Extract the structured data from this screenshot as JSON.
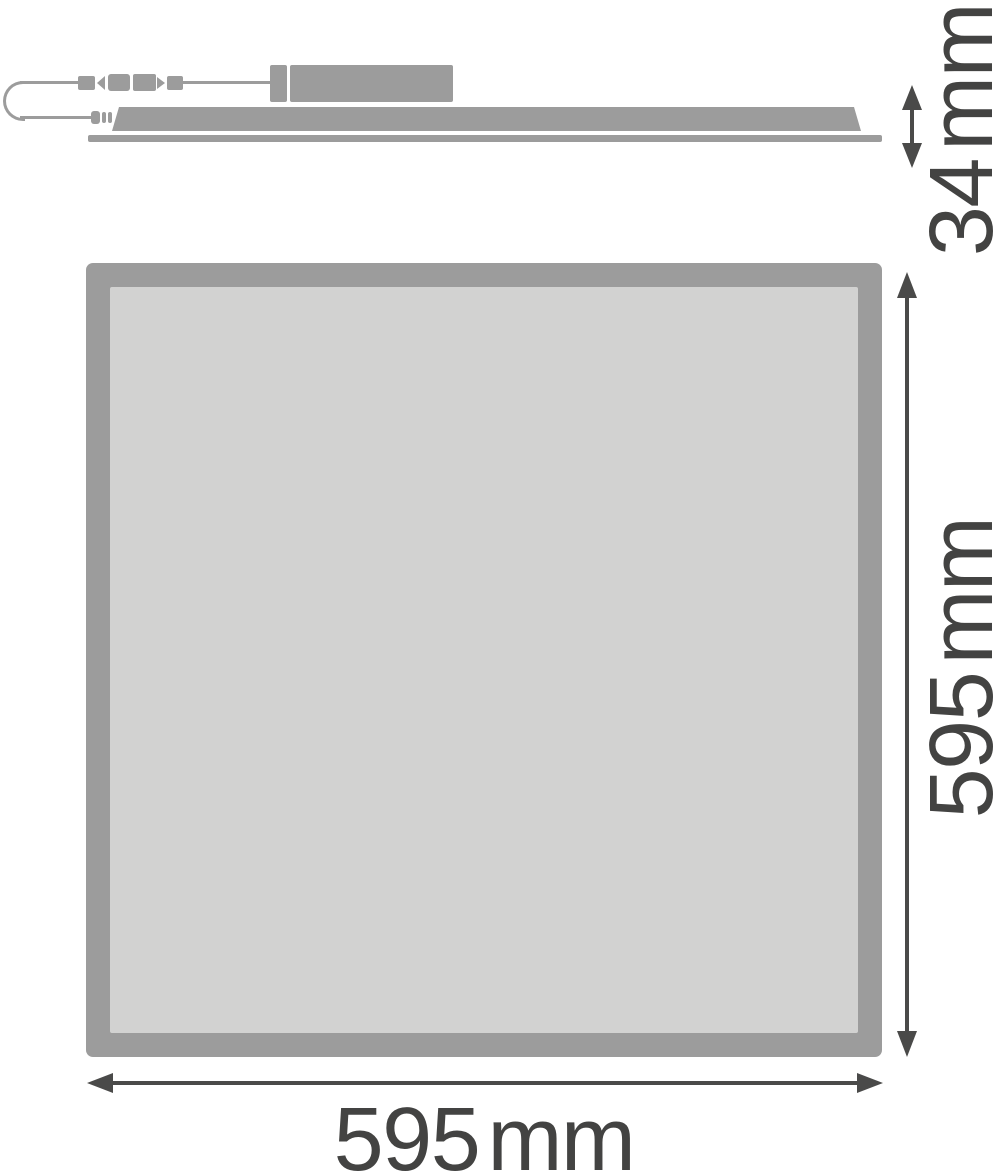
{
  "drawing": {
    "kind": "luminaire-dimension-drawing",
    "views": {
      "side_profile": "panel side view with external driver box and connector cable",
      "front": "square panel front view"
    }
  },
  "dimensions": {
    "height": "34 mm",
    "side": "595 mm",
    "width": "595 mm"
  },
  "colors": {
    "outline_gray": "#9C9C9C",
    "panel_fill_gray": "#D2D2D1",
    "dimension_arrow": "#4A4A49",
    "label_text": "#434342",
    "background": "#FFFFFF"
  }
}
